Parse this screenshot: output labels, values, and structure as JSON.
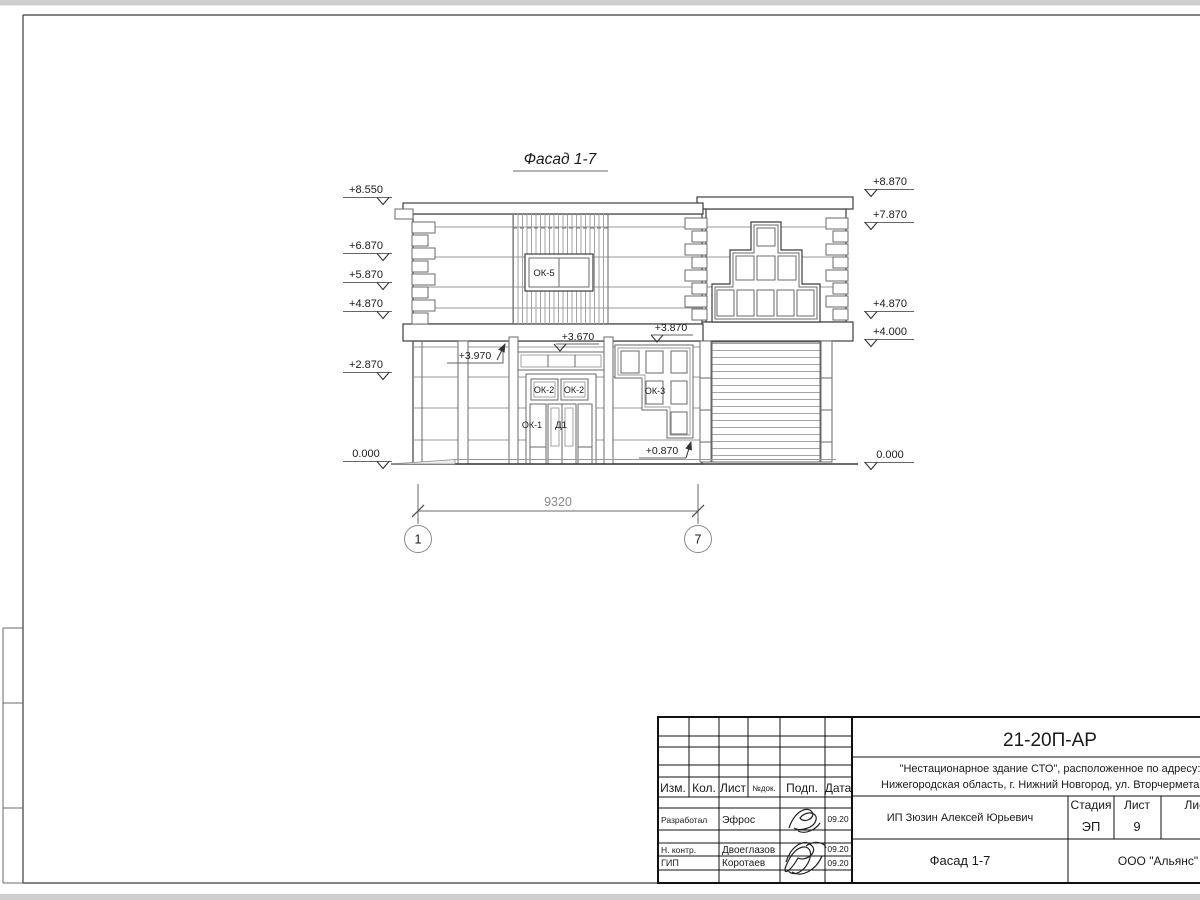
{
  "sheet": {
    "view_title": "Фасад 1-7",
    "dimension_value": "9320",
    "axis_left": "1",
    "axis_right": "7",
    "marks_left": [
      "+8.550",
      "+6.870",
      "+5.870",
      "+4.870",
      "+2.870",
      "0.000"
    ],
    "marks_right": [
      "+8.870",
      "+7.870",
      "+4.870",
      "+4.000",
      "0.000"
    ],
    "ann": {
      "a3970": "+3.970",
      "a3670": "+3.670",
      "a3870": "+3.870",
      "a0870": "+0.870"
    },
    "labels": {
      "ok5": "ОК-5",
      "ok2_left": "ОК-2",
      "ok2_right": "ОК-2",
      "ok1": "ОК-1",
      "d1": "Д1",
      "ok3": "ОК-3"
    }
  },
  "title_block": {
    "doc_number": "21-20П-АР",
    "project_line1": "\"Нестационарное здание СТО\", расположенное по адресу:",
    "project_line2": "Нижегородская область, г. Нижний Новгород, ул. Вторчермета, 1А",
    "col_izm": "Изм.",
    "col_kol": "Кол.",
    "col_list": "Лист",
    "col_ndok": "№док.",
    "col_podp": "Подп.",
    "col_data": "Дата",
    "rows": [
      {
        "role": "Разработал",
        "name": "Эфрос",
        "date": "09.20"
      },
      {
        "role": "Н. контр.",
        "name": "Двоеглазов",
        "date": "09.20"
      },
      {
        "role": "ГИП",
        "name": "Коротаев",
        "date": "09.20"
      }
    ],
    "client": "ИП Зюзин Алексей Юрьевич",
    "stage_label": "Стадия",
    "sheet_label": "Лист",
    "sheets_label": "Листов",
    "stage_value": "ЭП",
    "sheet_value": "9",
    "sheet_title": "Фасад 1-7",
    "company": "ООО \"Альянс\""
  }
}
